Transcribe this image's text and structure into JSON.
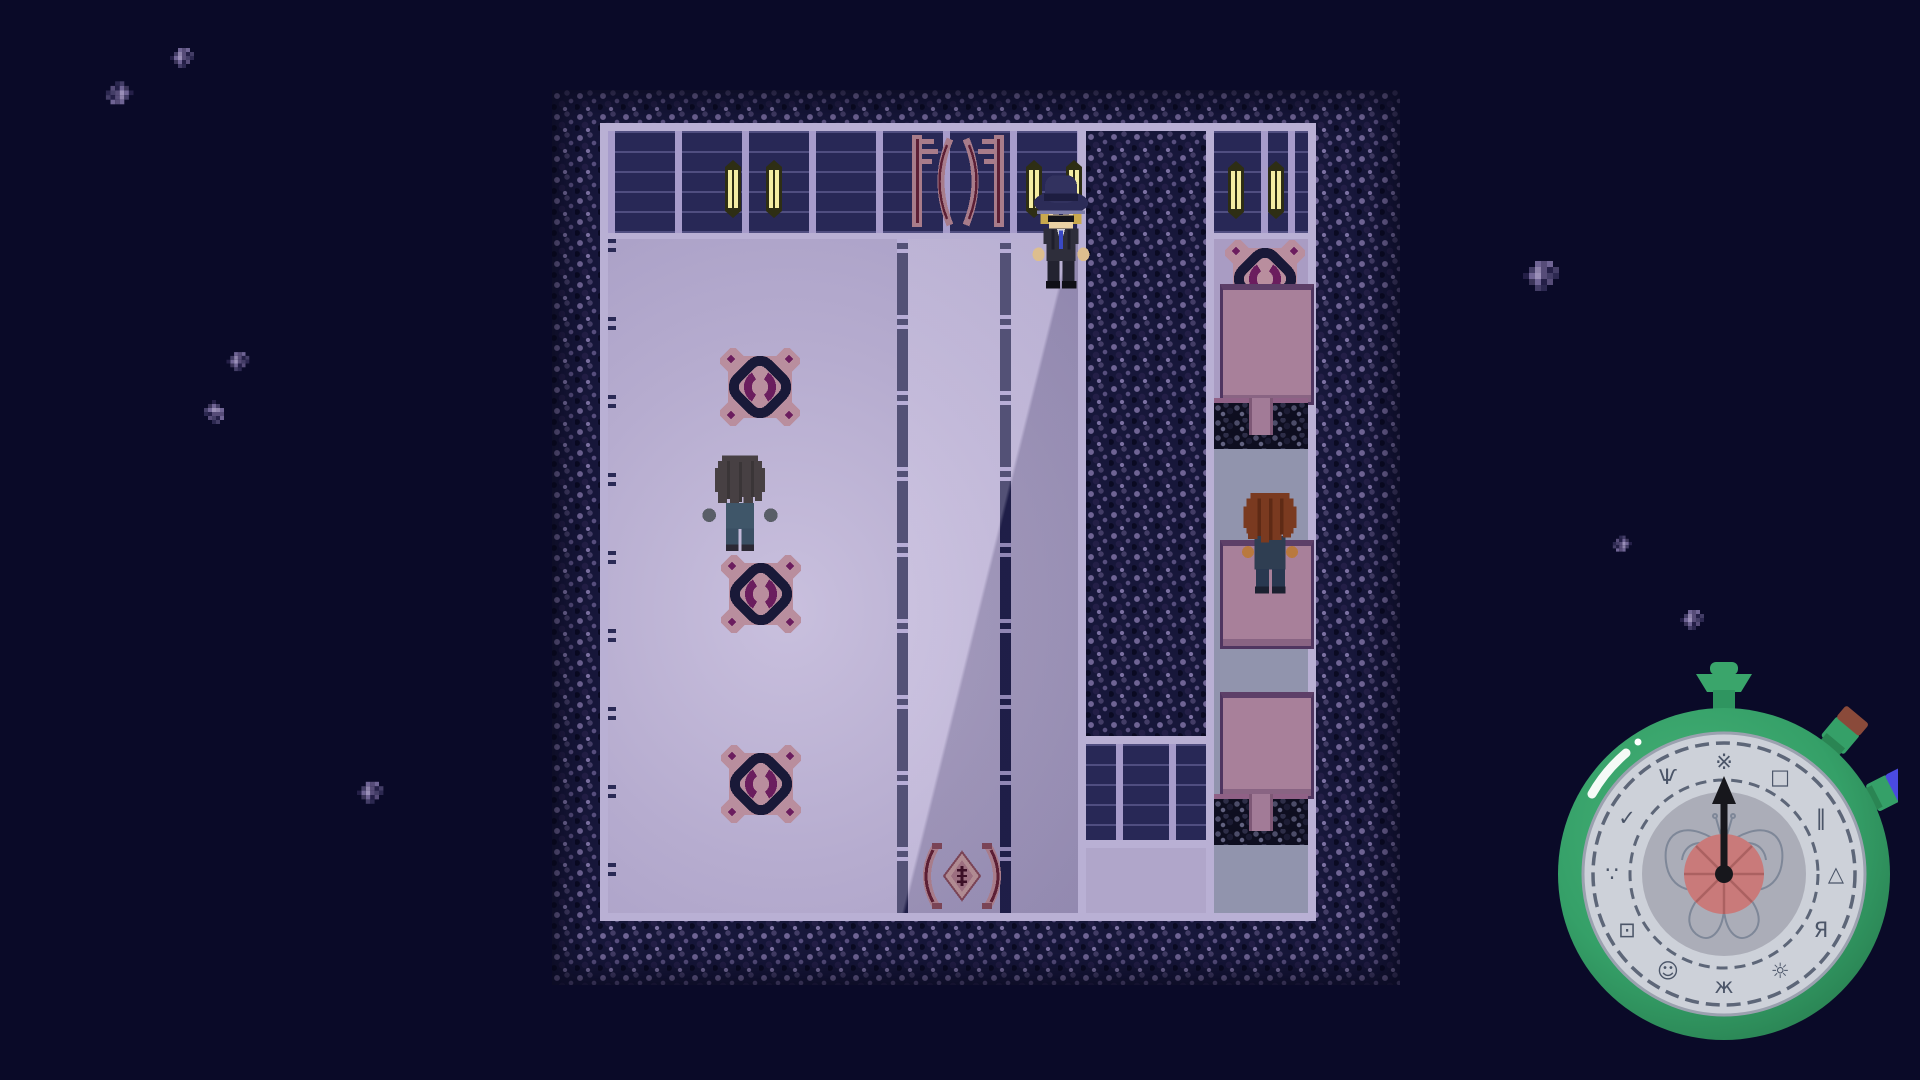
{
  "scene": {
    "type": "top-down pixel RPG dormitory room at night",
    "palette": {
      "background": "#0a0a28",
      "stone_wall": "#17173a",
      "wall_panel": "#282856",
      "wall_frame": "#b9b0d4",
      "floor": "#b6accf",
      "floor_glow": "#c9c0de",
      "corridor_floor": "#a99cc3",
      "gray_floor": "#9194ad",
      "rug_pink": "#b98e9e",
      "rug_navy": "#191938",
      "rug_purple": "#6b1d5e",
      "bed_pink": "#a8809a",
      "bed_border": "#4f3560",
      "candle_yellow": "#f4eda2"
    },
    "characters": [
      {
        "id": "player",
        "label": "gray-haired character facing down"
      },
      {
        "id": "hat-man",
        "label": "blond NPC with dark hat, sunglasses and suit"
      },
      {
        "id": "guest",
        "label": "auburn curly-haired NPC facing up"
      }
    ],
    "props": {
      "rugs": 4,
      "beds": 3,
      "wall_candles": 6,
      "rock_clusters": 8
    }
  },
  "hud": {
    "clock": {
      "shape": "green stopwatch with butterfly face",
      "hand_angle_deg": 0,
      "colors": {
        "body": "#35a068",
        "face": "#cdd1d9",
        "inner_disc": "#abadb8",
        "center_disc": "#c97a7a",
        "hand": "#17171c",
        "button_red_tip": "#8a4a3a",
        "button_blue_tip": "#4a4ae0"
      },
      "glyphs": [
        {
          "char": "※"
        },
        {
          "char": "□"
        },
        {
          "char": "‖"
        },
        {
          "char": "△"
        },
        {
          "char": "Я"
        },
        {
          "char": "☼"
        },
        {
          "char": "ж"
        },
        {
          "char": "☺"
        },
        {
          "char": "⊡"
        },
        {
          "char": "∵"
        },
        {
          "char": "✓"
        },
        {
          "char": "Ѱ"
        }
      ]
    }
  }
}
